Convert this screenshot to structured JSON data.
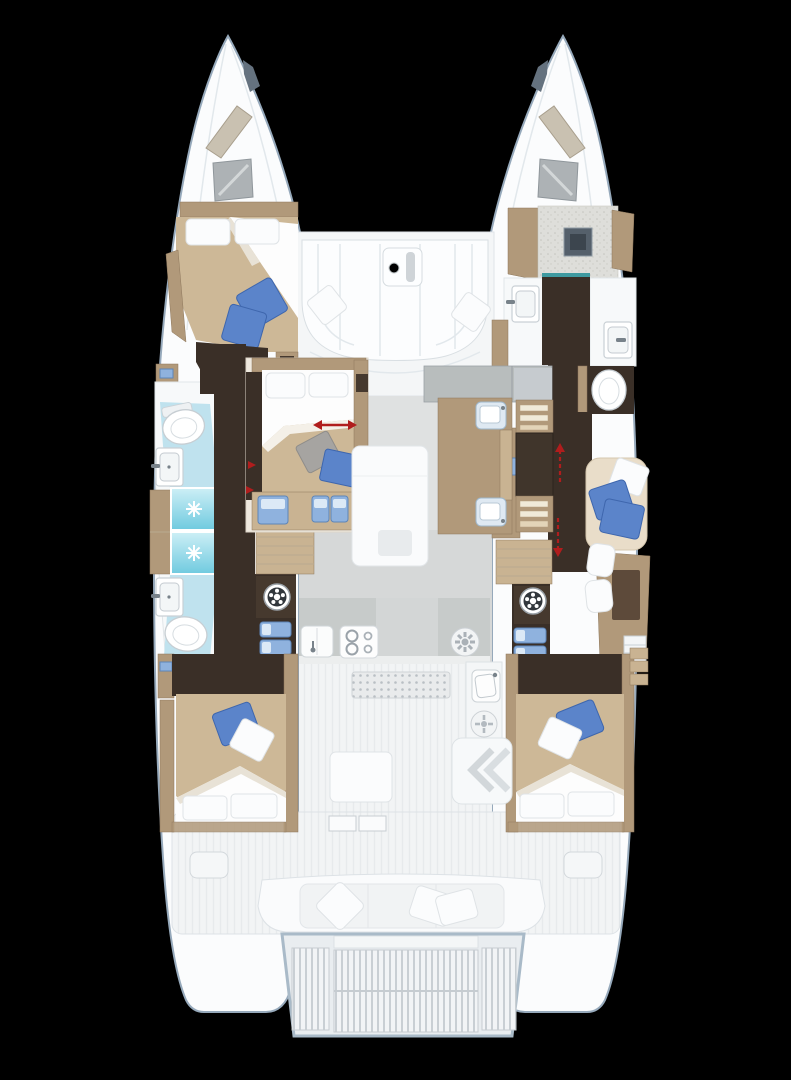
{
  "title": "Catamaran interior deck plan, overhead view, bows up",
  "background": "#000000",
  "colors": {
    "background": "#000000",
    "hullFill": "#fbfcfd",
    "hullOutline": "#96a9bb",
    "floorDark": "#3a2f27",
    "wood": "#b1997a",
    "woodLight": "#c9b392",
    "woodDark": "#8d775c",
    "blanket": "#cdb897",
    "sheet": "#fdfdfd",
    "pillowBlue": "#5b84ca",
    "pillowGray": "#a6a4a1",
    "showerAqua": "#7ed2e5",
    "tileBlue": "#bfe2ee",
    "counterGray": "#c7cbca",
    "saloonFloor": "#dfe1e1",
    "tableDark": "#40352b",
    "stepBlue": "#8fb2de",
    "red": "#b01d1d"
  },
  "legend": {
    "red_arrows": "door / sliding panel direction indicators",
    "cyan_cells": "shower cubicles with drain",
    "dark_floor": "hull walkway flooring"
  },
  "vessel": {
    "type": "sailing catamaran floor plan",
    "view": "top-down, bows at top, swim platform at bottom",
    "port_hull": {
      "bow_deck": [
        "deck hatch",
        "cabin skylight"
      ],
      "forward_cabin": {
        "bed": "double berth",
        "pillows": [
          "white",
          "white",
          "blue",
          "blue"
        ]
      },
      "forward_head": [
        "toilet",
        "washbasin"
      ],
      "shower_room": [
        "shower cubicle",
        "shower cubicle"
      ],
      "aft_head": [
        "washbasin",
        "toilet"
      ],
      "companionway": [
        "stairs",
        "washing machine",
        "step stools"
      ],
      "aft_cabin": {
        "bed": "double berth",
        "pillows": [
          "blue",
          "white",
          "white",
          "white"
        ]
      }
    },
    "starboard_hull": {
      "bow_deck": [
        "deck hatch",
        "cabin skylight"
      ],
      "forepeak": [
        "crew / storage area",
        "floor hatch"
      ],
      "washroom": [
        "washbasin port side",
        "washbasin hull side",
        "toilet"
      ],
      "lounge_nook": {
        "pillows": [
          "white",
          "blue",
          "blue"
        ]
      },
      "companionway": [
        "stairs",
        "washing machine",
        "step stools"
      ],
      "desk_area": [
        "desk with blotter",
        "seat cushions",
        "drawer unit"
      ],
      "aft_cabin": {
        "bed": "double berth",
        "pillows": [
          "blue",
          "white",
          "white",
          "white"
        ]
      }
    },
    "bridgedeck": {
      "foredeck_lounge": [
        "u-shaped sofa",
        "cocktail table",
        "pillow",
        "pillow"
      ],
      "forward_cabin": {
        "bed": "double berth",
        "pillows": [
          "white",
          "white",
          "gray",
          "blue"
        ],
        "step_stools": 3
      },
      "saloon": [
        "forward sideboard",
        "settee table",
        "galley island with twin sinks",
        "dining table",
        "bench seats"
      ],
      "aft_galley": [
        "double sink",
        "stove top",
        "vent hob",
        "grill grate",
        "side sink",
        "side hob"
      ],
      "cockpit": [
        "cockpit table",
        "l-shaped seat with steps",
        "aft bench with pillows",
        "engine hatch port",
        "engine hatch starboard",
        "sliding door threshold"
      ],
      "transom": [
        "swim platform",
        "teak grating"
      ]
    }
  }
}
